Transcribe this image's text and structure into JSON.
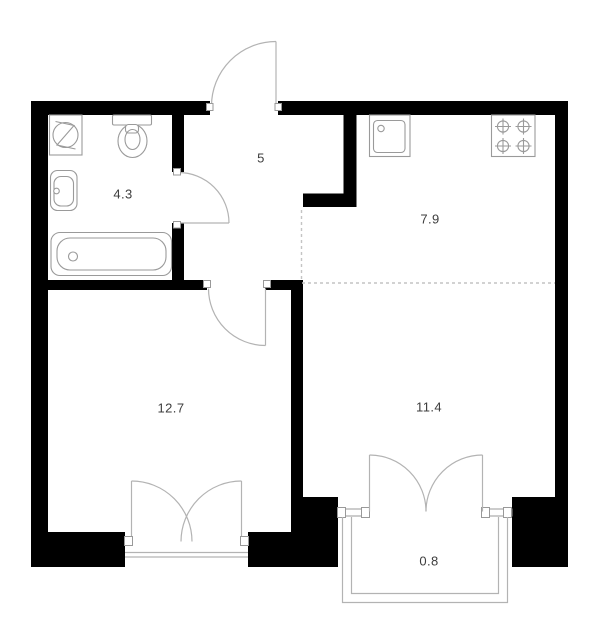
{
  "floorplan": {
    "rooms": [
      {
        "id": "bathroom",
        "area": "4.3"
      },
      {
        "id": "hallway",
        "area": "5"
      },
      {
        "id": "kitchen",
        "area": "7.9"
      },
      {
        "id": "bedroom",
        "area": "12.7"
      },
      {
        "id": "living-room",
        "area": "11.4"
      },
      {
        "id": "balcony",
        "area": "0.8"
      }
    ],
    "fixture_icons": [
      "washing-machine-icon",
      "toilet-icon",
      "bathroom-sink-icon",
      "bathtub-icon",
      "kitchen-sink-icon",
      "stove-icon"
    ],
    "colors": {
      "wall": "#000000",
      "fixture_line": "#9a9a9a",
      "door_line": "#b3b3b3",
      "dashed_zone_line": "#c4c4c4",
      "label_text": "#3d3d3d",
      "background": "#ffffff"
    }
  }
}
